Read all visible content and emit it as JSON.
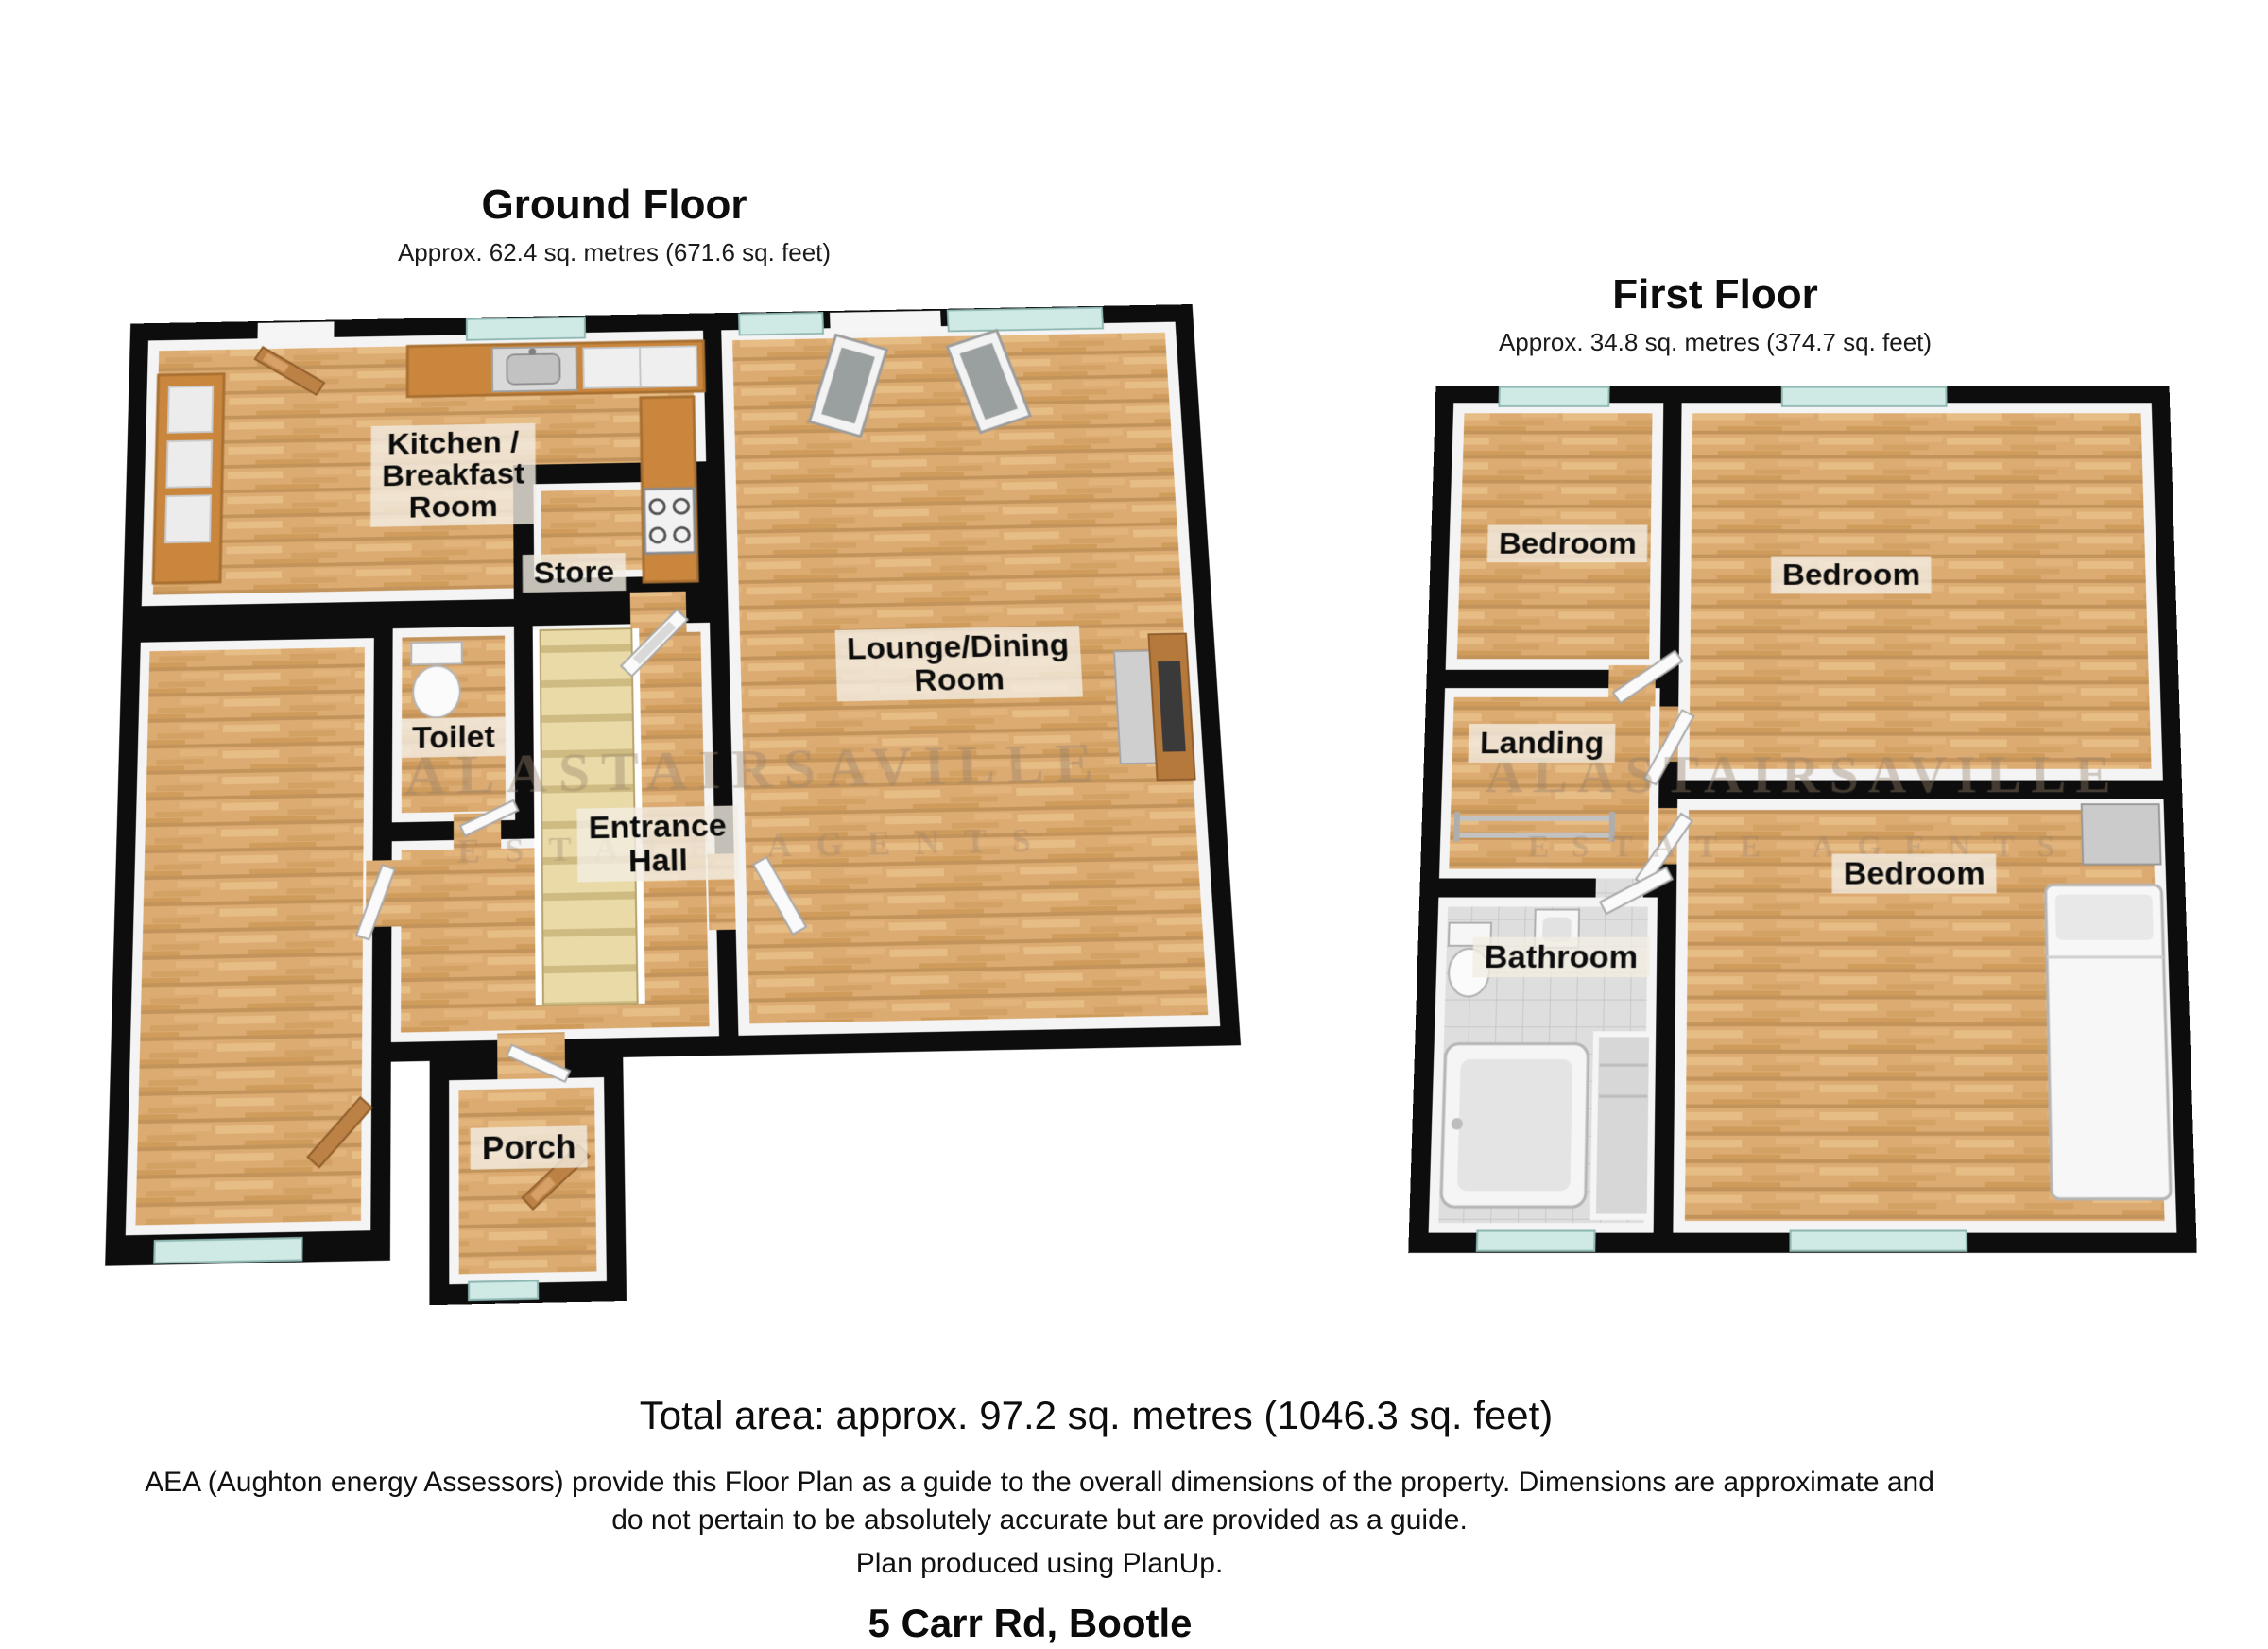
{
  "ground_floor": {
    "title": "Ground Floor",
    "subtitle": "Approx. 62.4 sq. metres (671.6 sq. feet)",
    "rooms": {
      "kitchen": "Kitchen /\nBreakfast\nRoom",
      "store": "Store",
      "toilet": "Toilet",
      "entrance_hall": "Entrance\nHall",
      "lounge": "Lounge/Dining\nRoom",
      "porch": "Porch"
    }
  },
  "first_floor": {
    "title": "First Floor",
    "subtitle": "Approx. 34.8 sq. metres (374.7 sq. feet)",
    "rooms": {
      "bedroom_top_left": "Bedroom",
      "bedroom_top_right": "Bedroom",
      "landing": "Landing",
      "bathroom": "Bathroom",
      "bedroom_bottom_right": "Bedroom"
    }
  },
  "watermark": {
    "line1": "ALASTAIRSAVILLE",
    "line2": "ESTATE AGENTS"
  },
  "footer": {
    "total_area": "Total area: approx. 97.2 sq. metres (1046.3 sq. feet)",
    "disclaimer_line1": "AEA (Aughton energy Assessors) provide this Floor Plan as a guide to the overall dimensions of the property. Dimensions are approximate and",
    "disclaimer_line2": "do not pertain to be absolutely accurate but are provided as a guide.",
    "produced": "Plan produced using PlanUp.",
    "address": "5 Carr Rd, Bootle"
  },
  "colors": {
    "wall": "#0d0d0d",
    "wood_floor": "#dcab72",
    "window_glass": "#cfe9e5",
    "kitchen_counter": "#c9863c",
    "stairs": "#e9daa8",
    "bathroom_tile": "#dedede",
    "label_background": "rgba(243,237,226,0.80)",
    "watermark": "rgba(152,130,108,0.40)"
  }
}
